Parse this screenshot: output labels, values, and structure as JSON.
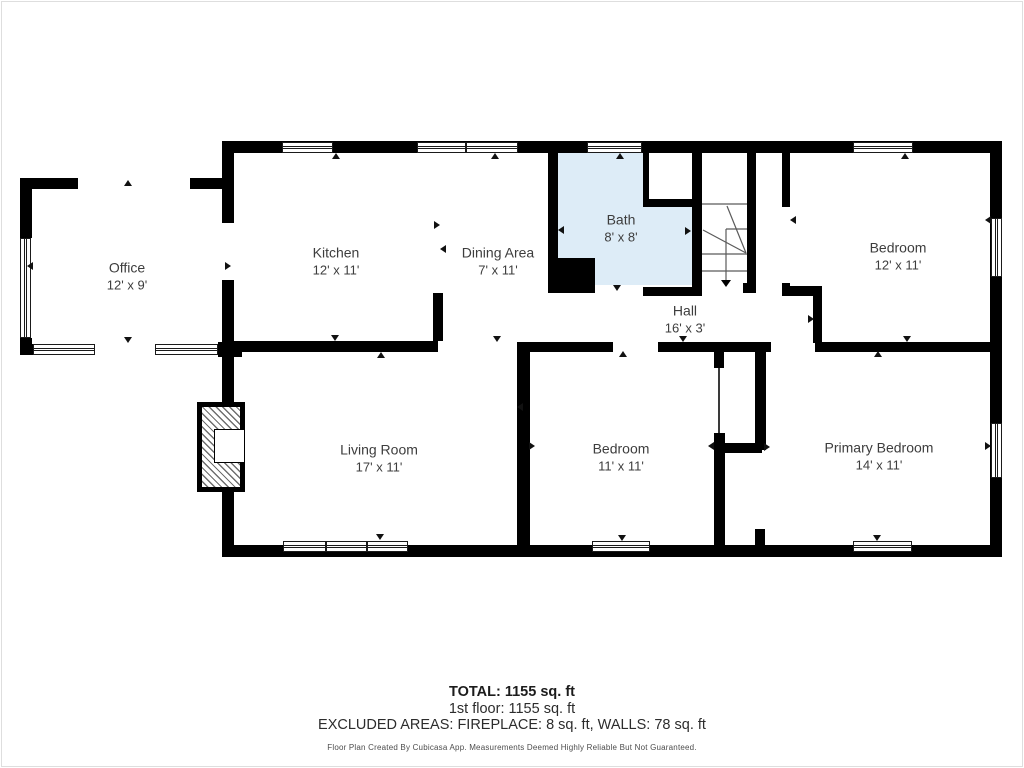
{
  "colors": {
    "wall": "#000000",
    "bath_fill": "#ddecf7",
    "stair_line": "#5a5a5a",
    "marker": "#111111",
    "label_text": "#3d3d3d"
  },
  "rooms": [
    {
      "name": "Office",
      "dims": "12' x 9'",
      "cx": 127,
      "cy": 276
    },
    {
      "name": "Kitchen",
      "dims": "12' x 11'",
      "cx": 336,
      "cy": 261
    },
    {
      "name": "Dining Area",
      "dims": "7' x 11'",
      "cx": 498,
      "cy": 261
    },
    {
      "name": "Bath",
      "dims": "8' x 8'",
      "cx": 621,
      "cy": 228
    },
    {
      "name": "Bedroom",
      "dims": "12' x 11'",
      "cx": 898,
      "cy": 256
    },
    {
      "name": "Hall",
      "dims": "16' x 3'",
      "cx": 685,
      "cy": 319
    },
    {
      "name": "Living Room",
      "dims": "17' x 11'",
      "cx": 379,
      "cy": 458
    },
    {
      "name": "Bedroom",
      "dims": "11' x 11'",
      "cx": 621,
      "cy": 457
    },
    {
      "name": "Primary Bedroom",
      "dims": "14' x 11'",
      "cx": 879,
      "cy": 456
    }
  ],
  "bath": {
    "fill": [
      558,
      153,
      134,
      132
    ],
    "notch": [
      649,
      153,
      43,
      46
    ]
  },
  "walls": [
    [
      222,
      141,
      780,
      12
    ],
    [
      222,
      545,
      780,
      12
    ],
    [
      222,
      141,
      12,
      82
    ],
    [
      222,
      280,
      12,
      277
    ],
    [
      990,
      141,
      12,
      416
    ],
    [
      20,
      178,
      58,
      11
    ],
    [
      190,
      178,
      34,
      11
    ],
    [
      20,
      178,
      12,
      60
    ],
    [
      20,
      338,
      12,
      17
    ],
    [
      20,
      344,
      13,
      11
    ],
    [
      218,
      342,
      24,
      15
    ],
    [
      222,
      341,
      216,
      11
    ],
    [
      517,
      342,
      96,
      10
    ],
    [
      658,
      342,
      113,
      10
    ],
    [
      815,
      342,
      180,
      10
    ],
    [
      433,
      293,
      10,
      48
    ],
    [
      548,
      153,
      10,
      105
    ],
    [
      548,
      258,
      47,
      35
    ],
    [
      692,
      153,
      10,
      139
    ],
    [
      643,
      153,
      6,
      46
    ],
    [
      643,
      199,
      59,
      8
    ],
    [
      643,
      287,
      59,
      9
    ],
    [
      747,
      153,
      9,
      139
    ],
    [
      743,
      283,
      13,
      10
    ],
    [
      782,
      153,
      8,
      54
    ],
    [
      782,
      283,
      8,
      10
    ],
    [
      782,
      286,
      40,
      10
    ],
    [
      813,
      295,
      9,
      48
    ],
    [
      517,
      348,
      13,
      197
    ],
    [
      714,
      352,
      10,
      16
    ],
    [
      714,
      433,
      11,
      20
    ],
    [
      722,
      443,
      40,
      10
    ],
    [
      755,
      342,
      11,
      108
    ],
    [
      714,
      453,
      11,
      92
    ],
    [
      755,
      529,
      10,
      16
    ]
  ],
  "thin_walls": [
    [
      718,
      368,
      2,
      65
    ]
  ],
  "windows": [
    {
      "o": "h",
      "r": [
        282,
        142,
        51,
        11
      ]
    },
    {
      "o": "h",
      "r": [
        417,
        142,
        49,
        11
      ]
    },
    {
      "o": "h",
      "r": [
        466,
        142,
        52,
        11
      ]
    },
    {
      "o": "h",
      "r": [
        587,
        142,
        55,
        11
      ]
    },
    {
      "o": "h",
      "r": [
        853,
        142,
        60,
        11
      ]
    },
    {
      "o": "h",
      "r": [
        283,
        541,
        43,
        11
      ]
    },
    {
      "o": "h",
      "r": [
        326,
        541,
        41,
        11
      ]
    },
    {
      "o": "h",
      "r": [
        367,
        541,
        41,
        11
      ]
    },
    {
      "o": "h",
      "r": [
        592,
        541,
        58,
        11
      ]
    },
    {
      "o": "h",
      "r": [
        853,
        541,
        59,
        11
      ]
    },
    {
      "o": "h",
      "r": [
        33,
        344,
        62,
        11
      ]
    },
    {
      "o": "h",
      "r": [
        155,
        344,
        63,
        11
      ]
    },
    {
      "o": "v",
      "r": [
        20,
        238,
        11,
        100
      ]
    },
    {
      "o": "v",
      "r": [
        991,
        218,
        11,
        59
      ]
    },
    {
      "o": "v",
      "r": [
        991,
        423,
        11,
        55
      ]
    }
  ],
  "markers": [
    {
      "d": "up",
      "x": 128,
      "y": 183
    },
    {
      "d": "down",
      "x": 128,
      "y": 340
    },
    {
      "d": "left",
      "x": 30,
      "y": 266
    },
    {
      "d": "right",
      "x": 228,
      "y": 266
    },
    {
      "d": "up",
      "x": 336,
      "y": 156
    },
    {
      "d": "up",
      "x": 495,
      "y": 156
    },
    {
      "d": "up",
      "x": 620,
      "y": 156
    },
    {
      "d": "up",
      "x": 905,
      "y": 156
    },
    {
      "d": "right",
      "x": 437,
      "y": 225
    },
    {
      "d": "left",
      "x": 443,
      "y": 249
    },
    {
      "d": "left",
      "x": 561,
      "y": 230
    },
    {
      "d": "right",
      "x": 688,
      "y": 231
    },
    {
      "d": "down",
      "x": 617,
      "y": 288
    },
    {
      "d": "left",
      "x": 793,
      "y": 220
    },
    {
      "d": "left",
      "x": 988,
      "y": 220
    },
    {
      "d": "down",
      "x": 335,
      "y": 338
    },
    {
      "d": "up",
      "x": 381,
      "y": 355
    },
    {
      "d": "down",
      "x": 497,
      "y": 339
    },
    {
      "d": "down",
      "x": 380,
      "y": 537
    },
    {
      "d": "left",
      "x": 520,
      "y": 407
    },
    {
      "d": "right",
      "x": 532,
      "y": 446
    },
    {
      "d": "up",
      "x": 623,
      "y": 354
    },
    {
      "d": "down",
      "x": 683,
      "y": 339
    },
    {
      "d": "left",
      "x": 711,
      "y": 446
    },
    {
      "d": "right",
      "x": 767,
      "y": 447
    },
    {
      "d": "right",
      "x": 811,
      "y": 319
    },
    {
      "d": "up",
      "x": 878,
      "y": 354
    },
    {
      "d": "down",
      "x": 907,
      "y": 339
    },
    {
      "d": "right",
      "x": 988,
      "y": 446
    },
    {
      "d": "down",
      "x": 877,
      "y": 538
    },
    {
      "d": "down",
      "x": 622,
      "y": 538
    }
  ],
  "stairs": {
    "lines": [
      [
        702,
        204,
        747,
        204
      ],
      [
        726,
        229,
        747,
        229
      ],
      [
        726,
        229,
        726,
        254
      ],
      [
        702,
        254,
        747,
        254
      ],
      [
        702,
        271,
        747,
        271
      ],
      [
        703,
        230,
        746,
        253
      ],
      [
        727,
        206,
        746,
        253
      ]
    ],
    "arrow": {
      "x": 726,
      "y1": 254,
      "y2": 280,
      "head_y": 287,
      "head_half": 5
    }
  },
  "fireplace": {
    "outer": [
      197,
      402,
      48,
      90
    ],
    "inner_box": [
      214,
      429,
      31,
      34
    ]
  },
  "summary": {
    "total": "TOTAL: 1155 sq. ft",
    "floor1": "1st floor: 1155 sq. ft",
    "excluded": "EXCLUDED AREAS: FIREPLACE: 8 sq. ft, WALLS: 78 sq. ft",
    "disclaimer": "Floor Plan Created By Cubicasa App. Measurements Deemed Highly Reliable But Not Guaranteed."
  }
}
